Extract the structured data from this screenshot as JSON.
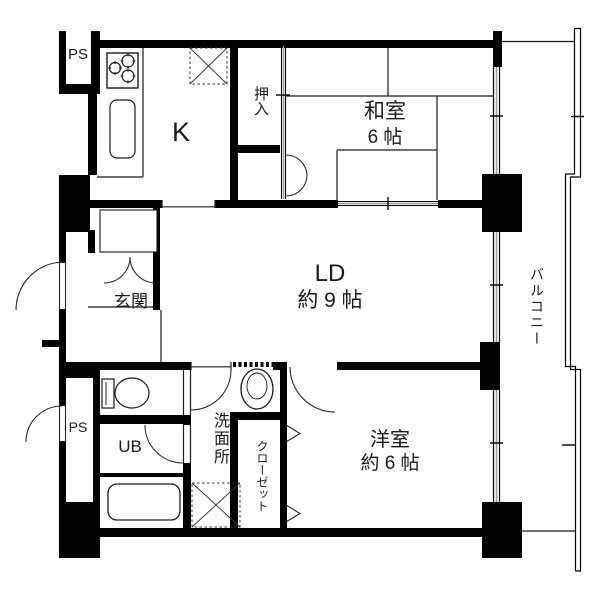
{
  "colors": {
    "wall": "#000000",
    "thin_line": "#1a1a1a",
    "window_center": "#9a9a9a",
    "background": "#ffffff"
  },
  "rooms": {
    "kitchen": {
      "name": "K"
    },
    "washitsu": {
      "name": "和室",
      "size": "6 帖"
    },
    "ld": {
      "name": "LD",
      "size": "約 9 帖"
    },
    "yoshitsu": {
      "name": "洋室",
      "size": "約 6 帖"
    },
    "genkan": {
      "name": "玄関"
    },
    "oshiire": {
      "name": "押入"
    },
    "senmenjo": {
      "name": "洗面所"
    },
    "closet": {
      "name": "クローゼット"
    },
    "unit_bath": {
      "name": "UB"
    },
    "balcony": {
      "name": "バルコニー"
    },
    "pipe_space_top": {
      "name": "PS"
    },
    "pipe_space_bottom": {
      "name": "PS"
    }
  }
}
